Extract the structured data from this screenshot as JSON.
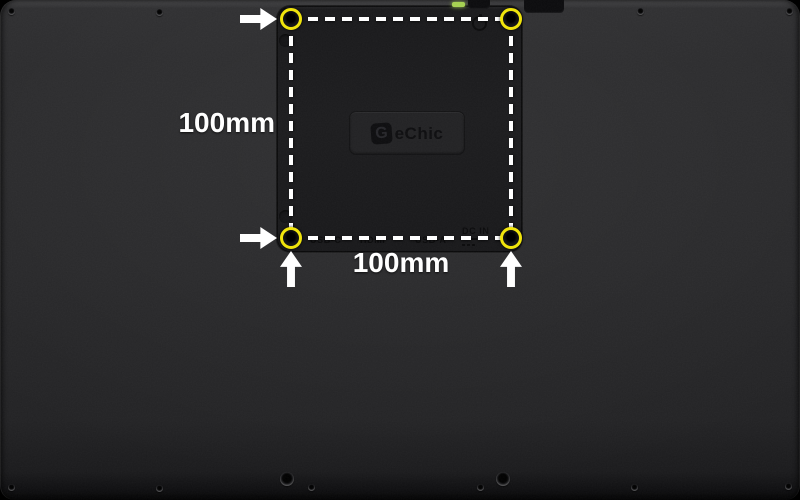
{
  "scene": {
    "title": "Rear view of GeChic portable monitor with VESA 100x100 mount hole spacing annotation"
  },
  "brand": {
    "g_mark": "G",
    "name": "eChic"
  },
  "annotations": {
    "vertical_dimension": "100mm",
    "horizontal_dimension": "100mm"
  },
  "ports": {
    "usb_c": "USB-C",
    "hdmi": "HDMI",
    "usb_a": "USB-A",
    "dc_in": "DC IN"
  },
  "icons": {
    "arrow_right": "arrow-right-icon",
    "arrow_up": "arrow-up-icon",
    "power": "power-icon",
    "dc_symbol": "dc-symbol-icon",
    "mount_hole_marker": "yellow-circle-marker"
  },
  "colors": {
    "marker_yellow": "#f0e40c",
    "annotation_white": "#ffffff",
    "led_green": "#a6d251",
    "shell_dark": "#28282a",
    "panel_dark": "#1a1a1c"
  }
}
